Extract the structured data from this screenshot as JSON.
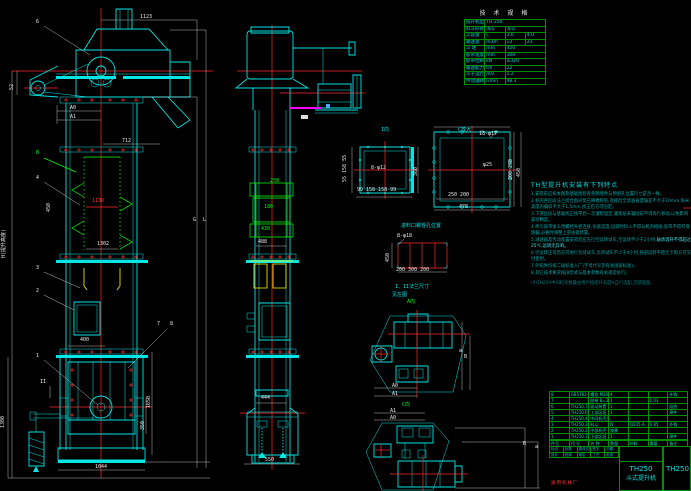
{
  "canvas": {
    "width": 691,
    "height": 491,
    "bg": "#000000"
  },
  "colors": {
    "geometry": "#00e5e5",
    "centerline": "#ff2a2a",
    "chain": "#00ff00",
    "bucket_section": "#ffff00",
    "dim_text": "#e8e8e8",
    "table_grid": "#008f00",
    "note_text": "#00a8a8",
    "magenta": "#ff00ff"
  },
  "spec_table": {
    "title": "技 术 规 格",
    "rows": [
      [
        "提升机型号",
        "TH 250"
      ],
      [
        "料斗形式",
        "浅斗",
        "深斗"
      ],
      [
        "斗容量",
        "L",
        "3.0",
        "4.0"
      ],
      [
        "输送量",
        "m3/h",
        "13",
        "23"
      ],
      [
        "斗 距",
        "mm",
        "450"
      ],
      [
        "胶带宽度",
        "mm",
        "300"
      ],
      [
        "胶带拉断强度",
        "kN",
        "≥320"
      ],
      [
        "输送能力",
        "t/h",
        "22"
      ],
      [
        "斗子运行速度",
        "m/s",
        "1.2"
      ],
      [
        "传动轴转速",
        "r/min",
        "48.3"
      ]
    ]
  },
  "notes": {
    "heading": "TH型提升机安装有下列特点",
    "items": [
      {
        "t": "1.安装前应按本图及基础图检查各预埋件与预留孔位置尺寸是否一致。"
      },
      {
        "t": "2.机壳各区段法兰结合面间垫石棉橡胶纸,连接后全高垂直度偏差不大于10mm,每米高度内偏斜不大于1.5mm,找正后方可固定。"
      },
      {
        "t": "3.下部区段与基础找正找平后一次灌浆固定,灌浆层未凝固前不得再行移动,以免影响安装精度。"
      },
      {
        "t": "4.牵引胶带接头用螺栓夹板连接,张紧适度;运转时料斗不得与机壳相碰,胶带不得打滑跑偏,必要时调整上部张紧装置。"
      },
      {
        "t": "5.减速器及传动装置安装后应先行空运转试车,空运转不少于2小时,",
        "h": "轴承温升不得超过25℃,运转无异响。"
      },
      {
        "t": "6.空运转正常后方可进行负荷试车,负荷试车不少于4小时,各部运转平稳无卡阻方可交付使用。"
      },
      {
        "t": "7.外购件均按二级标准入厂(字母代号见有关国家标准)。"
      },
      {
        "t": "8.其它技术要求按JB型式与基本参数有关规定执行。"
      }
    ],
    "footnote": "(9)TH250中间机壳数量由用户按提升高度H自行选配,见基础图。"
  },
  "bom": {
    "cols": 7,
    "rows": [
      [
        "8",
        "GB5782-86",
        "螺栓 M20×65",
        "4",
        "",
        "",
        "外购"
      ],
      [
        "7",
        "",
        "胶带 B=300",
        "1",
        "",
        "0.03",
        ""
      ],
      [
        "6",
        "TH250.7",
        "驱动装置",
        "1",
        "",
        "",
        "组合"
      ],
      [
        "5",
        "TH250.6",
        "上部区段",
        "1",
        "",
        "",
        "焊件"
      ],
      [
        "4",
        "TH250.4(5)",
        "中间机壳加长段",
        "",
        "",
        "",
        ""
      ],
      [
        "3",
        "TH250.3",
        "料斗",
        "N",
        "Q235-A",
        "0.85",
        "外购"
      ],
      [
        "2",
        "TH250.2",
        "中部机壳",
        "按需",
        "",
        "",
        ""
      ],
      [
        "1",
        "TH250.1",
        "下部区段",
        "1",
        "",
        "",
        "焊件"
      ]
    ],
    "headers": [
      "件号",
      "代 号",
      "名 称",
      "数量",
      "材料",
      "重量",
      "备注"
    ]
  },
  "title_block": {
    "model": "TH250",
    "name": "斗式提升机",
    "drawing_no": "TH250",
    "company": "通用机械厂",
    "sig_rows": [
      [
        "标记",
        "处数",
        "更改文件号",
        "签字",
        "日期"
      ],
      [
        "设计",
        "校核",
        "审定",
        "工艺",
        "批准"
      ]
    ]
  },
  "labels": {
    "b6": {
      "t": "6",
      "x": 36,
      "y": 20,
      "c": "w"
    },
    "d1123": {
      "t": "1123",
      "x": 140,
      "y": 15,
      "c": "w"
    },
    "d52": {
      "t": "52",
      "x": 10,
      "y": 90,
      "c": "w",
      "r": 1
    },
    "dA0": {
      "t": "A0",
      "x": 70,
      "y": 106,
      "c": "w"
    },
    "dA1": {
      "t": "A1",
      "x": 70,
      "y": 115,
      "c": "w"
    },
    "d712": {
      "t": "712",
      "x": 122,
      "y": 139,
      "c": "w"
    },
    "bB": {
      "t": "B",
      "x": 36,
      "y": 151,
      "c": "g"
    },
    "b4": {
      "t": "4",
      "x": 36,
      "y": 176,
      "c": "w"
    },
    "d450L": {
      "t": "450",
      "x": 47,
      "y": 212,
      "c": "w",
      "r": 1
    },
    "d1130": {
      "t": "1130",
      "x": 92,
      "y": 199,
      "c": "r"
    },
    "d1302": {
      "t": "1302",
      "x": 97,
      "y": 242,
      "c": "w"
    },
    "dH": {
      "t": "H(提升高度)",
      "x": 2,
      "y": 258,
      "c": "w",
      "r": 1
    },
    "dG": {
      "t": "G",
      "x": 193,
      "y": 218,
      "c": "w"
    },
    "dL": {
      "t": "L",
      "x": 203,
      "y": 218,
      "c": "w"
    },
    "b3": {
      "t": "3",
      "x": 36,
      "y": 266,
      "c": "w"
    },
    "b2": {
      "t": "2",
      "x": 36,
      "y": 289,
      "c": "w"
    },
    "d400": {
      "t": "400",
      "x": 80,
      "y": 338,
      "c": "w"
    },
    "b7": {
      "t": "7",
      "x": 157,
      "y": 322,
      "c": "w"
    },
    "b8": {
      "t": "8",
      "x": 170,
      "y": 322,
      "c": "w"
    },
    "b1": {
      "t": "1",
      "x": 36,
      "y": 354,
      "c": "w"
    },
    "dII": {
      "t": "II",
      "x": 40,
      "y": 380,
      "c": "w"
    },
    "d1300": {
      "t": "1300",
      "x": 1,
      "y": 428,
      "c": "w",
      "r": 1
    },
    "d1650": {
      "t": "1650",
      "x": 147,
      "y": 408,
      "c": "w",
      "r": 1
    },
    "d350": {
      "t": "350",
      "x": 141,
      "y": 430,
      "c": "w",
      "r": 1
    },
    "d1044": {
      "t": "1044",
      "x": 95,
      "y": 465,
      "c": "w"
    },
    "d250": {
      "t": "250",
      "x": 270,
      "y": 179,
      "c": "g"
    },
    "d180": {
      "t": "180",
      "x": 264,
      "y": 205,
      "c": "g"
    },
    "d438": {
      "t": "438",
      "x": 261,
      "y": 227,
      "c": "g"
    },
    "d488": {
      "t": "488",
      "x": 258,
      "y": 240,
      "c": "w"
    },
    "d444": {
      "t": "444",
      "x": 261,
      "y": 396,
      "c": "w"
    },
    "d550": {
      "t": "550",
      "x": 265,
      "y": 458,
      "c": "w"
    },
    "lblI": {
      "t": "I向",
      "x": 381,
      "y": 128,
      "c": "c"
    },
    "f1l": {
      "t": "55 158 55",
      "x": 343,
      "y": 182,
      "c": "w",
      "r": 1
    },
    "n8f12": {
      "t": "8-φ12",
      "x": 371,
      "y": 166,
      "c": "w"
    },
    "d360": {
      "t": "360",
      "x": 414,
      "y": 176,
      "c": "w",
      "r": 1
    },
    "f1b": {
      "t": "99 158 158 99",
      "x": 357,
      "y": 188,
      "c": "w"
    },
    "lblC": {
      "t": "C放大",
      "x": 458,
      "y": 128,
      "c": "c"
    },
    "n13f17": {
      "t": "13-φ17",
      "x": 479,
      "y": 132,
      "c": "w"
    },
    "dphi25": {
      "t": "φ25",
      "x": 483,
      "y": 163,
      "c": "w"
    },
    "f2b": {
      "t": "250 200",
      "x": 448,
      "y": 193,
      "c": "w"
    },
    "d478": {
      "t": "478",
      "x": 459,
      "y": 205,
      "c": "w"
    },
    "f2r": {
      "t": "200 250",
      "x": 509,
      "y": 180,
      "c": "w",
      "r": 1
    },
    "f2r2": {
      "t": "450",
      "x": 517,
      "y": 177,
      "c": "w",
      "r": 1
    },
    "lblGrid": {
      "t": "进料口螺栓孔位置",
      "x": 401,
      "y": 224,
      "c": "c"
    },
    "n8f18": {
      "t": "8-φ18",
      "x": 397,
      "y": 234,
      "c": "w"
    },
    "d450g": {
      "t": "450",
      "x": 386,
      "y": 262,
      "c": "w",
      "r": 1
    },
    "gridb": {
      "t": "200 300 200",
      "x": 396,
      "y": 268,
      "c": "w"
    },
    "lblSee1": {
      "t": "I、II法兰尺寸",
      "x": 395,
      "y": 285,
      "c": "c"
    },
    "lblSee2": {
      "t": "见左图",
      "x": 392,
      "y": 293,
      "c": "c"
    },
    "lblA": {
      "t": "A向",
      "x": 407,
      "y": 300,
      "c": "g"
    },
    "tA0": {
      "t": "A0",
      "x": 392,
      "y": 384,
      "c": "w"
    },
    "tA1": {
      "t": "A1",
      "x": 392,
      "y": 392,
      "c": "w"
    },
    "ta1": {
      "t": "a",
      "x": 459,
      "y": 349,
      "c": "w"
    },
    "tB1": {
      "t": "B",
      "x": 464,
      "y": 355,
      "c": "w"
    },
    "lblCdir": {
      "t": "C向",
      "x": 402,
      "y": 403,
      "c": "g"
    },
    "t2A1": {
      "t": "A1",
      "x": 390,
      "y": 409,
      "c": "w"
    },
    "t2A0": {
      "t": "A0",
      "x": 390,
      "y": 416,
      "c": "w"
    },
    "t2B": {
      "t": "B",
      "x": 523,
      "y": 442,
      "c": "w"
    },
    "t2a": {
      "t": "a",
      "x": 535,
      "y": 445,
      "c": "w"
    }
  }
}
